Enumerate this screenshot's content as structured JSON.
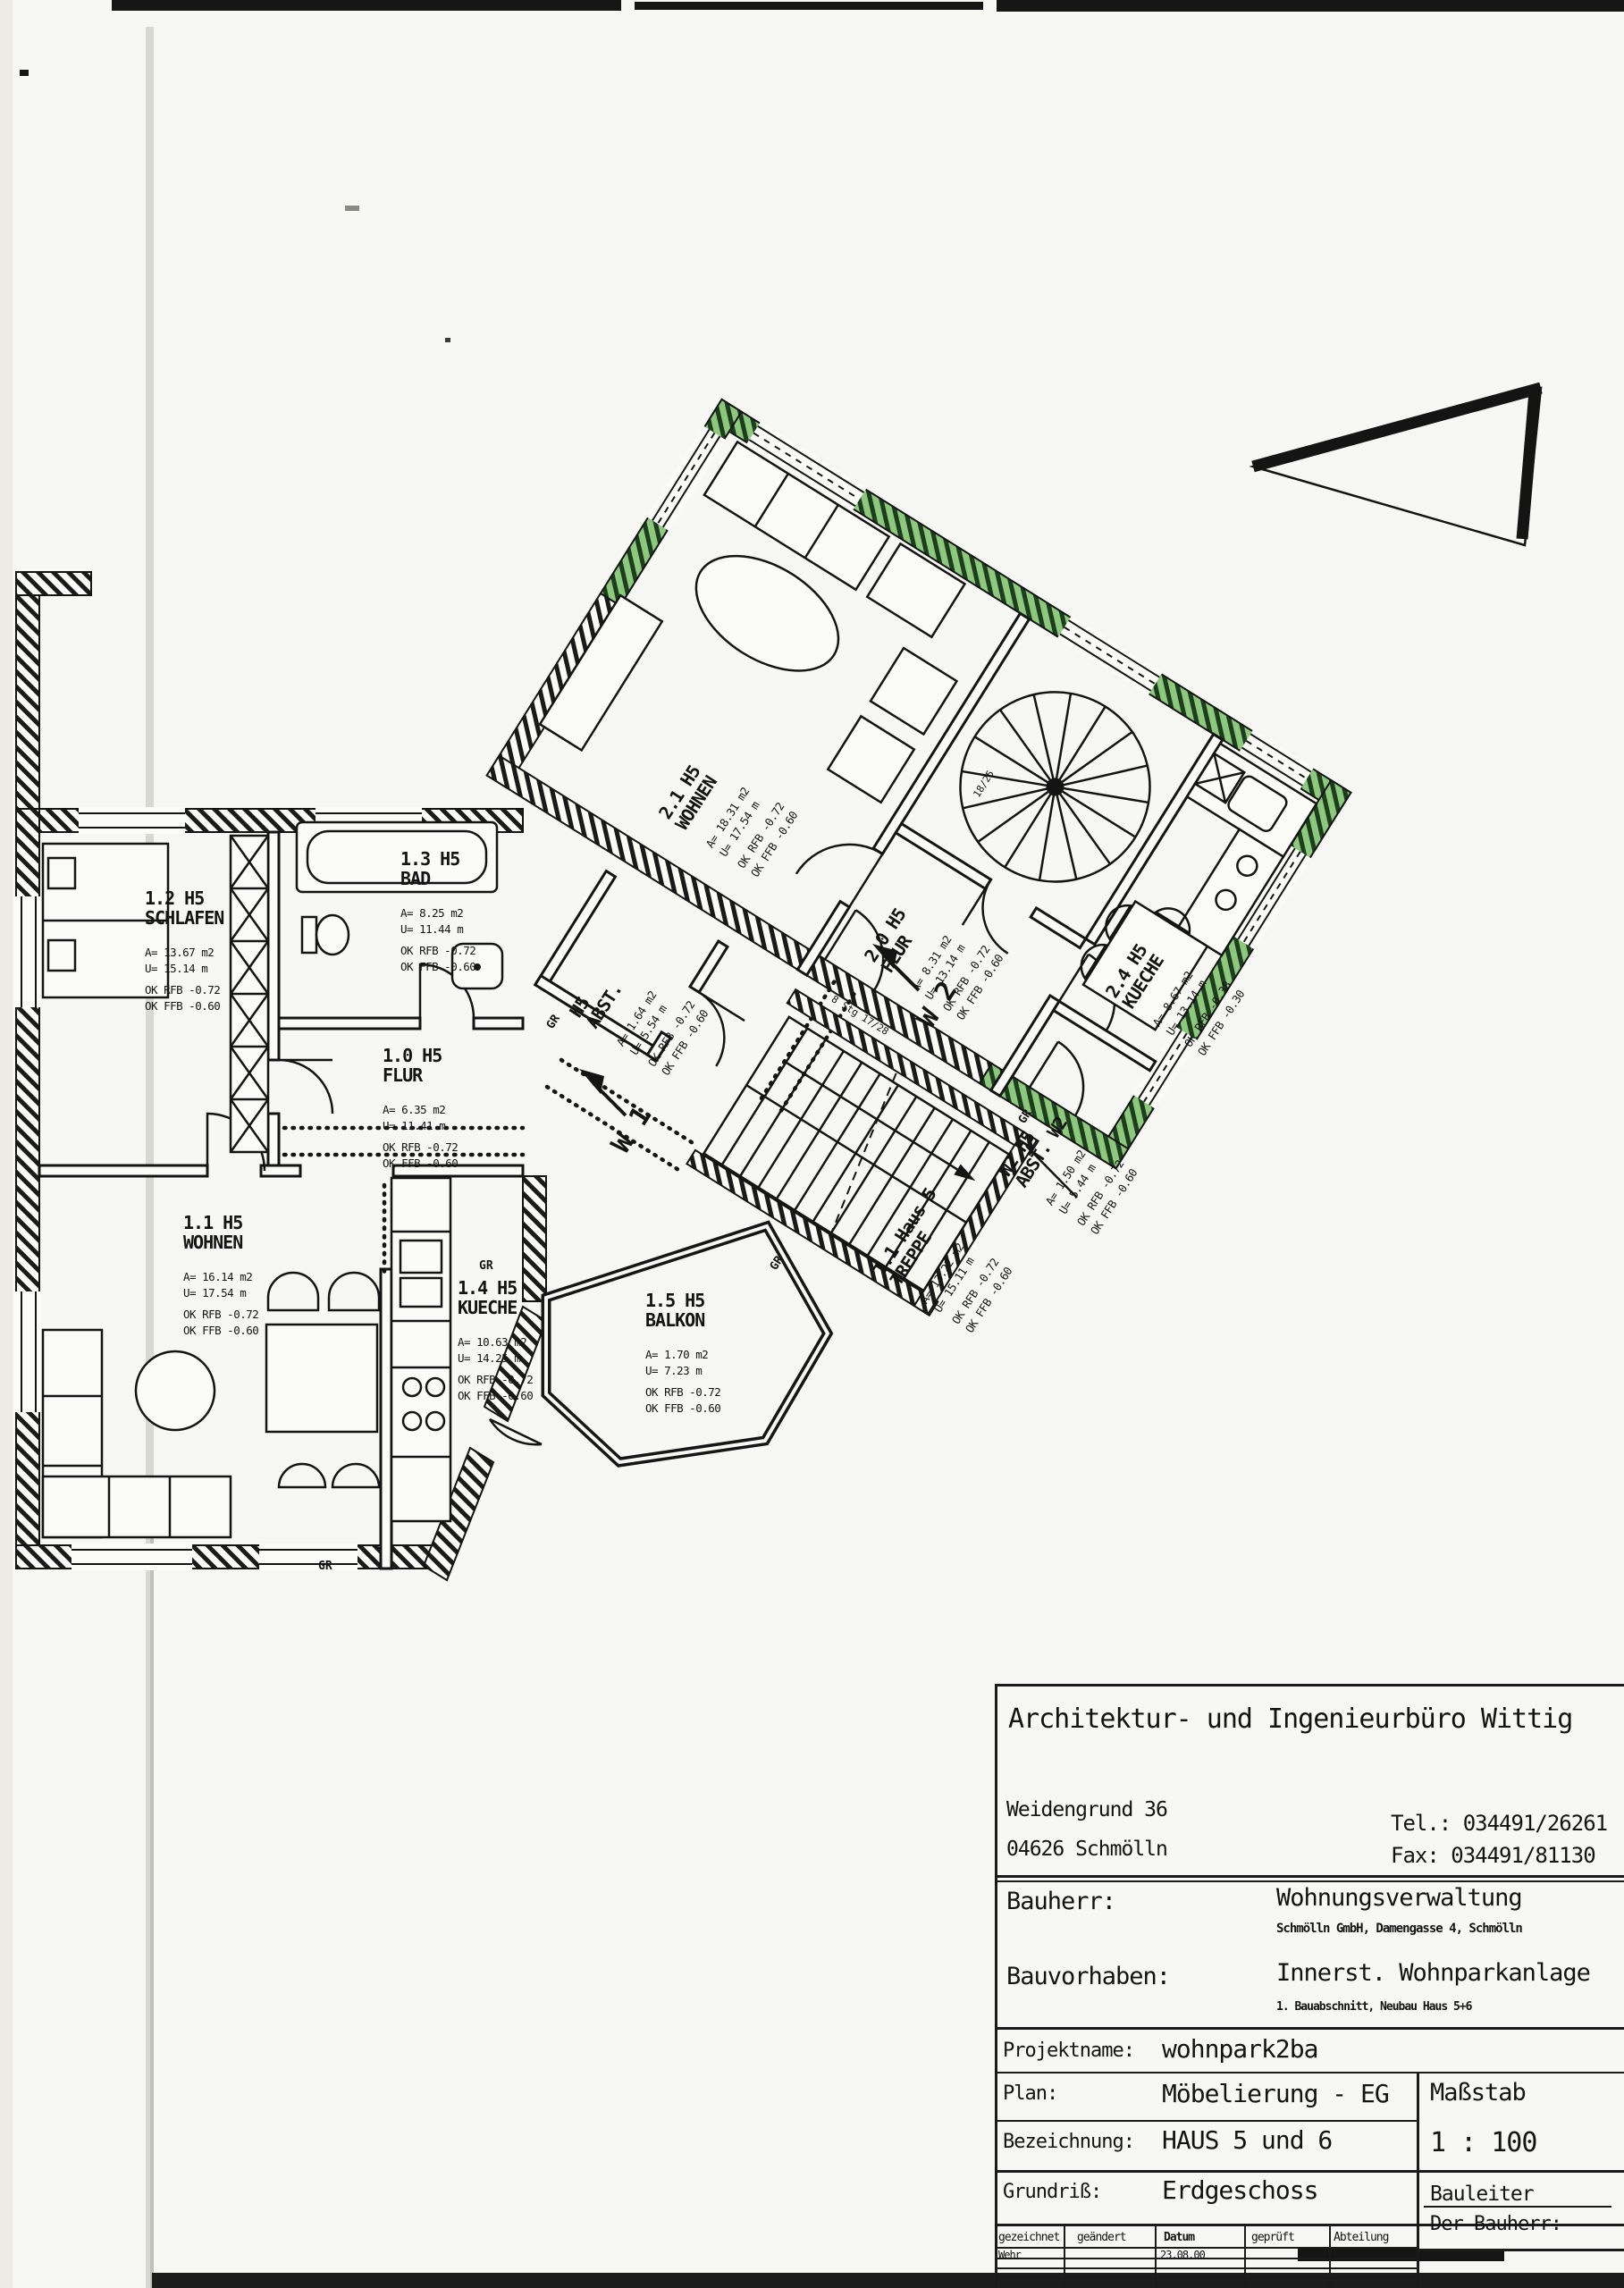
{
  "plan": {
    "rooms": [
      {
        "id": "1.0 H5",
        "name": "FLUR",
        "area": "A= 6.35 m2",
        "perim": "U= 11.41 m",
        "rfb": "OK RFB -0.72",
        "ffb": "OK FFB -0.60"
      },
      {
        "id": "1.1 H5",
        "name": "WOHNEN",
        "area": "A= 16.14 m2",
        "perim": "U= 17.54 m",
        "rfb": "OK RFB -0.72",
        "ffb": "OK FFB -0.60"
      },
      {
        "id": "1.2 H5",
        "name": "SCHLAFEN",
        "area": "A= 13.67 m2",
        "perim": "U= 15.14 m",
        "rfb": "OK RFB -0.72",
        "ffb": "OK FFB -0.60"
      },
      {
        "id": "1.3 H5",
        "name": "BAD",
        "area": "A= 8.25 m2",
        "perim": "U= 11.44 m",
        "rfb": "OK RFB -0.72",
        "ffb": "OK FFB -0.60"
      },
      {
        "id": "1.4 H5",
        "name": "KUECHE",
        "area": "A= 10.63 m2",
        "perim": "U= 14.25 m",
        "rfb": "OK RFB -0.72",
        "ffb": "OK FFB -0.60"
      },
      {
        "id": "1.5 H5",
        "name": "BALKON",
        "area": "A= 1.70 m2",
        "perim": "U= 7.23 m",
        "rfb": "OK RFB -0.72",
        "ffb": "OK FFB -0.60"
      },
      {
        "id": "2.0 H5",
        "name": "FLUR",
        "area": "A= 8.31 m2",
        "perim": "U= 13.14 m",
        "rfb": "OK RFB -0.72",
        "ffb": "OK FFB -0.60"
      },
      {
        "id": "2.1 H5",
        "name": "WOHNEN",
        "area": "A= 18.31 m2",
        "perim": "U= 17.54 m",
        "rfb": "OK RFB -0.72",
        "ffb": "OK FFB -0.60"
      },
      {
        "id": "2.4 H5",
        "name": "KUECHE",
        "area": "A= 8.67 m2",
        "perim": "U= 13.14 m",
        "rfb": "OK RFB -0.38",
        "ffb": "OK FFB -0.30"
      },
      {
        "id": "H5",
        "name": "ABST.",
        "area": "A= 1.64 m2",
        "perim": "U= 5.54 m",
        "rfb": "OK RFB -0.72",
        "ffb": "OK FFB -0.60"
      },
      {
        "id": "W2 H5",
        "name": "ABST. W2",
        "area": "A= 1.50 m2",
        "perim": "U= 5.44 m",
        "rfb": "OK RFB -0.72",
        "ffb": "OK FFB -0.60"
      },
      {
        "id": "T.1 Haus 5",
        "name": "TREPPE",
        "area": "A= 13.22 m2",
        "perim": "U= 15.11 m",
        "rfb": "OK RFB -0.72",
        "ffb": "OK FFB -0.60"
      }
    ],
    "markers": {
      "w1": "W 1",
      "w2": "W 2",
      "gr": "GR",
      "spiral_steps": "18/25",
      "stair_steps": "8 Stg 17/28"
    }
  },
  "titleblock": {
    "firm": "Architektur- und Ingenieurbüro Wittig",
    "address_line1": "Weidengrund 36",
    "address_line2": "04626 Schmölln",
    "tel": "Tel.: 034491/26261",
    "fax": "Fax: 034491/81130",
    "bauherr_label": "Bauherr:",
    "bauherr": "Wohnungsverwaltung",
    "bauherr_sub": "Schmölln GmbH, Damengasse 4, Schmölln",
    "bauvorhaben_label": "Bauvorhaben:",
    "bauvorhaben": "Innerst. Wohnparkanlage",
    "bauvorhaben_sub": "1. Bauabschnitt, Neubau Haus 5+6",
    "projektname_label": "Projektname:",
    "projektname": "wohnpark2ba",
    "plan_label": "Plan:",
    "plan": "Möbelierung - EG",
    "massstab_label": "Maßstab",
    "massstab": "1 : 100",
    "bezeichnung_label": "Bezeichnung:",
    "bezeichnung": "HAUS 5 und 6",
    "grundriss_label": "Grundriß:",
    "grundriss": "Erdgeschoss",
    "bauleiter_label": "Bauleiter",
    "der_bauherr_label": "Der Bauherr:",
    "revision_headers": {
      "c1": "gezeichnet",
      "c2": "geändert",
      "c3": "Datum",
      "c4": "geprüft",
      "c5": "Abteilung"
    },
    "revision_row": {
      "gezeichnet": "Wehr",
      "datum": "23.08.00"
    }
  },
  "colors": {
    "ink": "#141414",
    "highlight_green": "#8cc97c",
    "paper": "#f7f7f3"
  }
}
